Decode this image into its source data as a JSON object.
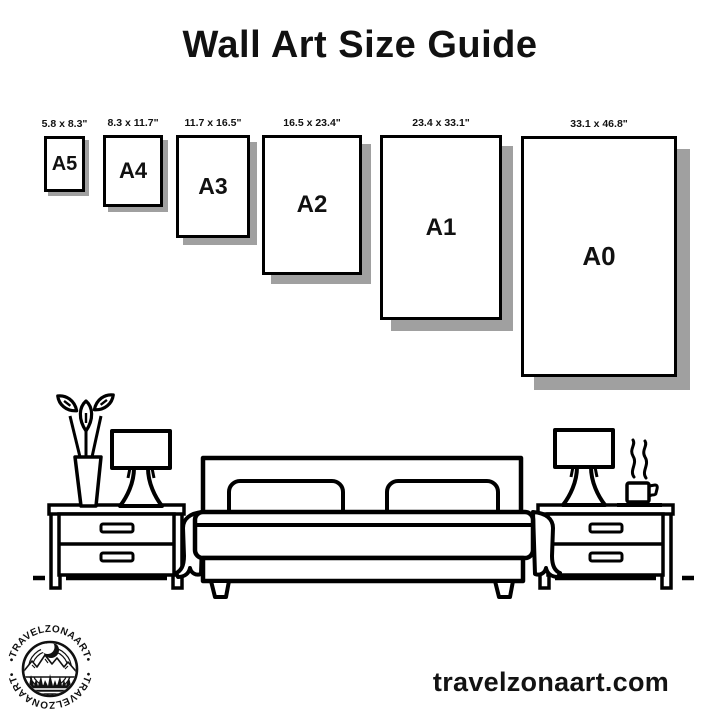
{
  "title": "Wall Art Size Guide",
  "sizes": {
    "items": [
      {
        "code": "A5",
        "dimensions": "5.8 x 8.3\""
      },
      {
        "code": "A4",
        "dimensions": "8.3 x 11.7\""
      },
      {
        "code": "A3",
        "dimensions": "11.7 x 16.5\""
      },
      {
        "code": "A2",
        "dimensions": "16.5 x 23.4\""
      },
      {
        "code": "A1",
        "dimensions": "23.4 x 33.1\""
      },
      {
        "code": "A0",
        "dimensions": "33.1 x 46.8\""
      }
    ]
  },
  "logo": {
    "arc_text_top": "•TRAVELZONAART•",
    "arc_text_bottom": "•TRAVELZONAART•"
  },
  "footer": {
    "website": "travelzonaart.com"
  },
  "colors": {
    "ink": "#000000",
    "frame_shadow": "#a0a0a0",
    "background": "#ffffff"
  }
}
